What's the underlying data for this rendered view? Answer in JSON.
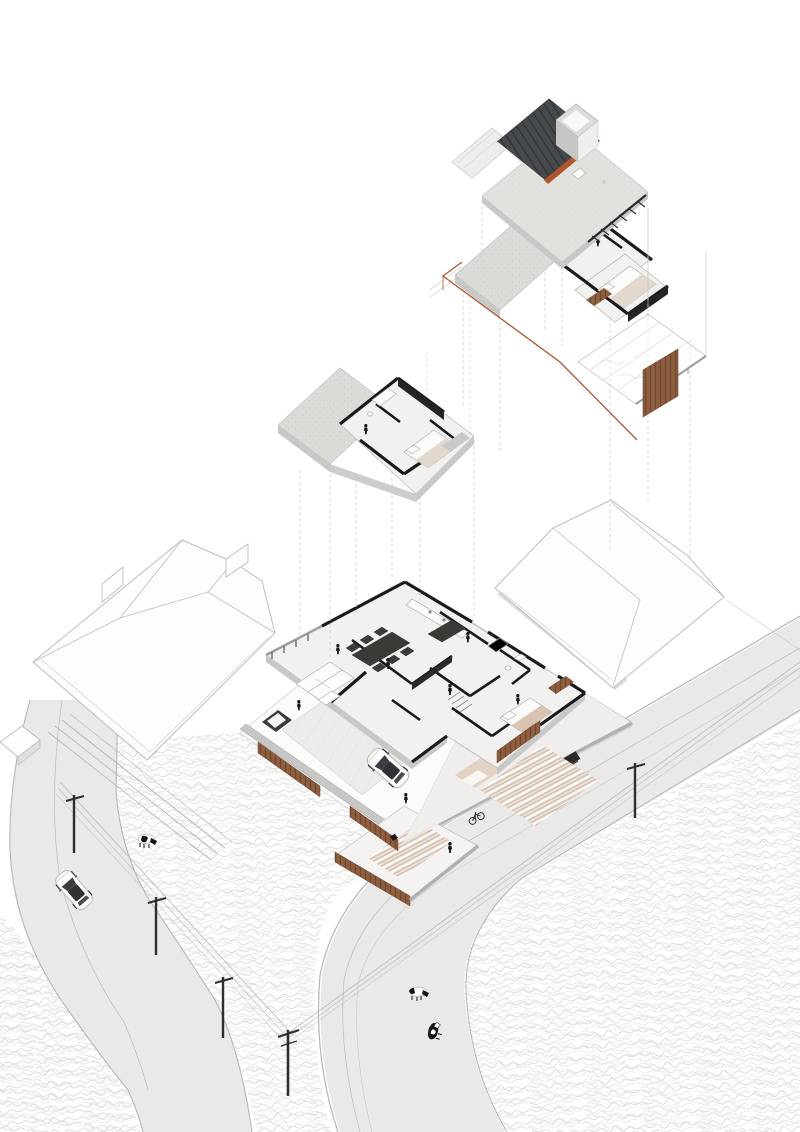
{
  "meta": {
    "drawing_type": "exploded-axonometric-architectural-drawing",
    "subject": "single-family-house-with-rural-site"
  },
  "colors": {
    "background": "#ffffff",
    "accent": "#b0552e",
    "wood": "#8a5a3c",
    "wood_dark": "#6f4630",
    "roof_dark": "#45494c",
    "roof_seam": "#2e3234",
    "ink": "#1a1a1a",
    "slab": "#c8c8c6",
    "floor": "#f1f1ef",
    "terrace_hatch": "#dbdbd7",
    "road": "#e9e9e8",
    "curb": "#b5b5b3",
    "field_stroke": "#dcdcda",
    "massing_line": "#bdbdbb",
    "wall_cap": "#c7c7c5",
    "patio_tan": "#d9c3b2",
    "gate": "#2b2b2b",
    "pole": "#2e2e2e",
    "wire": "#b9b9b7",
    "glass": "#3a3e41",
    "dash": "#cdcdcb",
    "person": "#161614"
  },
  "scene": {
    "levels": [
      {
        "id": "roof-level",
        "features": [
          "standing-seam-roof",
          "stair-bulkhead",
          "roof-terrace",
          "railing",
          "skylight"
        ]
      },
      {
        "id": "upper-floor",
        "features": [
          "terrace",
          "bathroom",
          "bedroom",
          "wood-screen-panel",
          "wireframe-deck"
        ]
      },
      {
        "id": "upper-floor-fragment",
        "features": [
          "terrace",
          "bathroom",
          "bedroom",
          "wardrobe"
        ]
      },
      {
        "id": "ground-floor",
        "features": [
          "living-room",
          "dining-room",
          "kitchen",
          "bedroom",
          "bathroom",
          "driveway",
          "patio"
        ]
      }
    ],
    "site": {
      "neighbor_buildings": 2,
      "boundary": [
        "concrete-walls",
        "wood-slat-fence",
        "entry-gate"
      ],
      "planters": 1,
      "gates": 1
    },
    "context": {
      "roads": 2,
      "power_poles": 5,
      "power_lines": 2,
      "cows": 3,
      "cars": 2,
      "bicycles": 1,
      "people_figures": 8
    }
  }
}
